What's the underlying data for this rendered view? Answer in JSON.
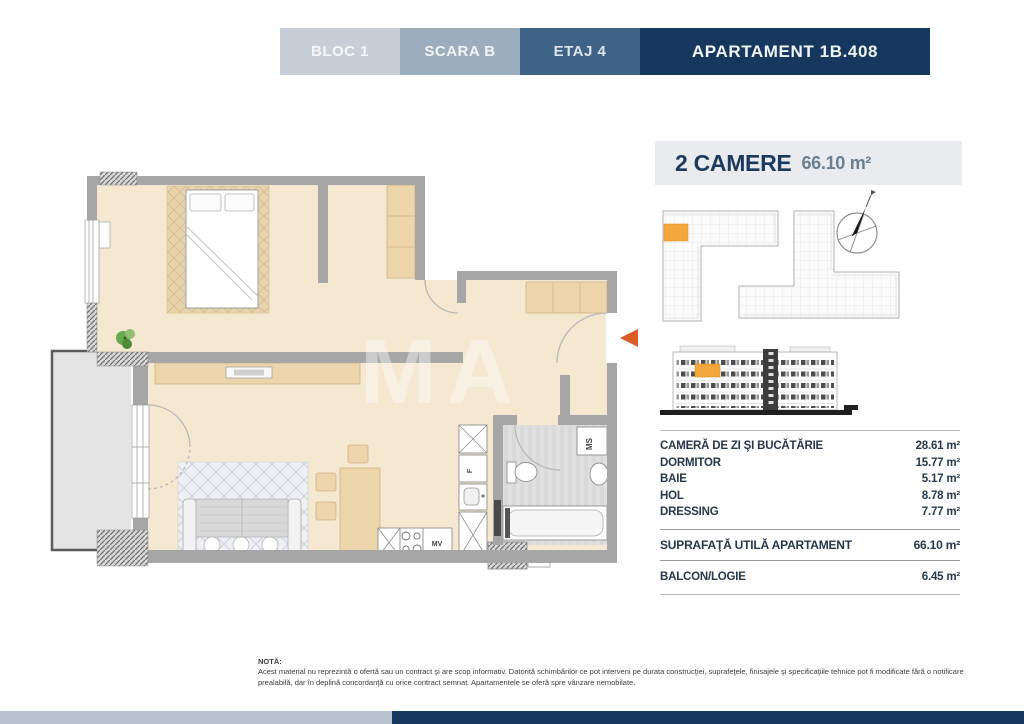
{
  "header": {
    "tabs": [
      {
        "label": "BLOC 1"
      },
      {
        "label": "SCARA B"
      },
      {
        "label": "ETAJ 4"
      },
      {
        "label": "APARTAMENT 1B.408"
      }
    ]
  },
  "title": {
    "rooms_count": "2 CAMERE",
    "area": "66.10 m²"
  },
  "plan": {
    "labels": {
      "washing_machine": "MS",
      "dishwasher": "MV",
      "fridge": "F"
    },
    "watermark": "MA"
  },
  "areas": {
    "rows": [
      {
        "label": "CAMERĂ DE ZI ŞI BUCĂTĂRIE",
        "value": "28.61 m²"
      },
      {
        "label": "DORMITOR",
        "value": "15.77 m²"
      },
      {
        "label": "BAIE",
        "value": "5.17 m²"
      },
      {
        "label": "HOL",
        "value": "8.78 m²"
      },
      {
        "label": "DRESSING",
        "value": "7.77 m²"
      }
    ],
    "total": {
      "label": "SUPRAFAŢĂ UTILĂ APARTAMENT",
      "value": "66.10 m²"
    },
    "balcony": {
      "label": "BALCON/LOGIE",
      "value": "6.45 m²"
    }
  },
  "note": {
    "heading": "NOTĂ:",
    "body": "Acest material nu reprezintă o ofertă sau un contract şi are scop informativ. Datorită schimbărilor ce pot interveni pe durata construcţiei, suprafeţele, finisajele şi specificaţiile tehnice pot fi modificate fără o notificare prealabilă, dar în deplină concordanţă cu orice contract semnat. Apartamentele se oferă spre vânzare nemobilate."
  },
  "colors": {
    "navy": "#16375e",
    "accent_orange": "#f3a63b",
    "arrow_orange": "#dd5b26",
    "wall_gray": "#a6a6a6",
    "floor_beige": "#f4e8d0"
  }
}
